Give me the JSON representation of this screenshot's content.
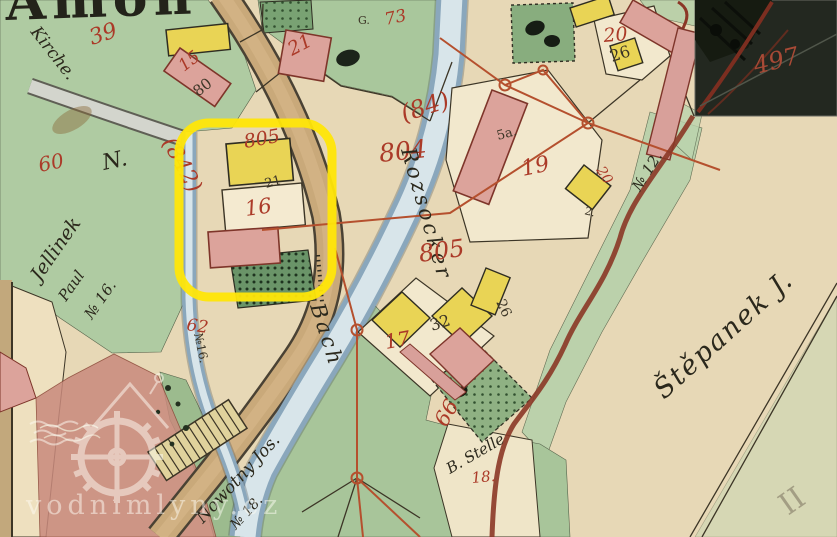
{
  "colors": {
    "parchment": "#e7d8b6",
    "cream": "#f2e8cd",
    "green": "#afcba2",
    "green_mid": "#8fb183",
    "green_dark": "#6a9468",
    "stream_edge": "#8aa7bc",
    "stream_core": "#d8e5ea",
    "road_tan": "#c9a97a",
    "road_dark": "#4a4234",
    "grey_road": "#d3d5cd",
    "salmon": "#c98a7d",
    "pink": "#dca39b",
    "pink_edge": "#7e352a",
    "yellow": "#e9d455",
    "red_ink": "#ab3a28",
    "survey_red": "#b5502e",
    "boundary_red": "#8b3726",
    "black_ink": "#3c3526",
    "highlight": "#ffe608",
    "inset_bg": "#232820",
    "inset_dark": "#161b11",
    "inset_red": "#a84a36",
    "watermark": "#fffdf5",
    "pencil": "#938c74",
    "sheet_tan": "#c2a87c"
  },
  "map": {
    "title_fragment": "Amon",
    "watermark_text": "vodnimlyny.cz",
    "inset_number": "497",
    "labels": {
      "n39": "39",
      "n60": "60",
      "n842": "(842)",
      "n805a": "805",
      "n804": "804",
      "n84": "(84)",
      "n73": "73",
      "n15": "15",
      "n80": "80",
      "n21a": "21",
      "n21b": "21",
      "n20a": "20",
      "n26a": "26",
      "n19": "19",
      "n5a": "5a.",
      "n20b": "20",
      "n16": "16",
      "n17": "17",
      "n32": "32",
      "n26b": "26",
      "n66": "66",
      "n62": "62",
      "n18": "18.",
      "n12": "№ 12.",
      "n16v": "№16.",
      "nG": "G.",
      "n2": "2.",
      "kirche": "Kirche.",
      "jel1": "Jellinek",
      "jel2": "Paul",
      "jel3": "№ 16.",
      "brook1": "Rozsocker",
      "brook2": "Bach",
      "now1": "Nowotny Jos.",
      "now2": "№ 18.",
      "bstelle": "B. Stelle",
      "stepanek": "Štěpanek J.",
      "pencil_mark": "II",
      "nmark": "N."
    }
  }
}
